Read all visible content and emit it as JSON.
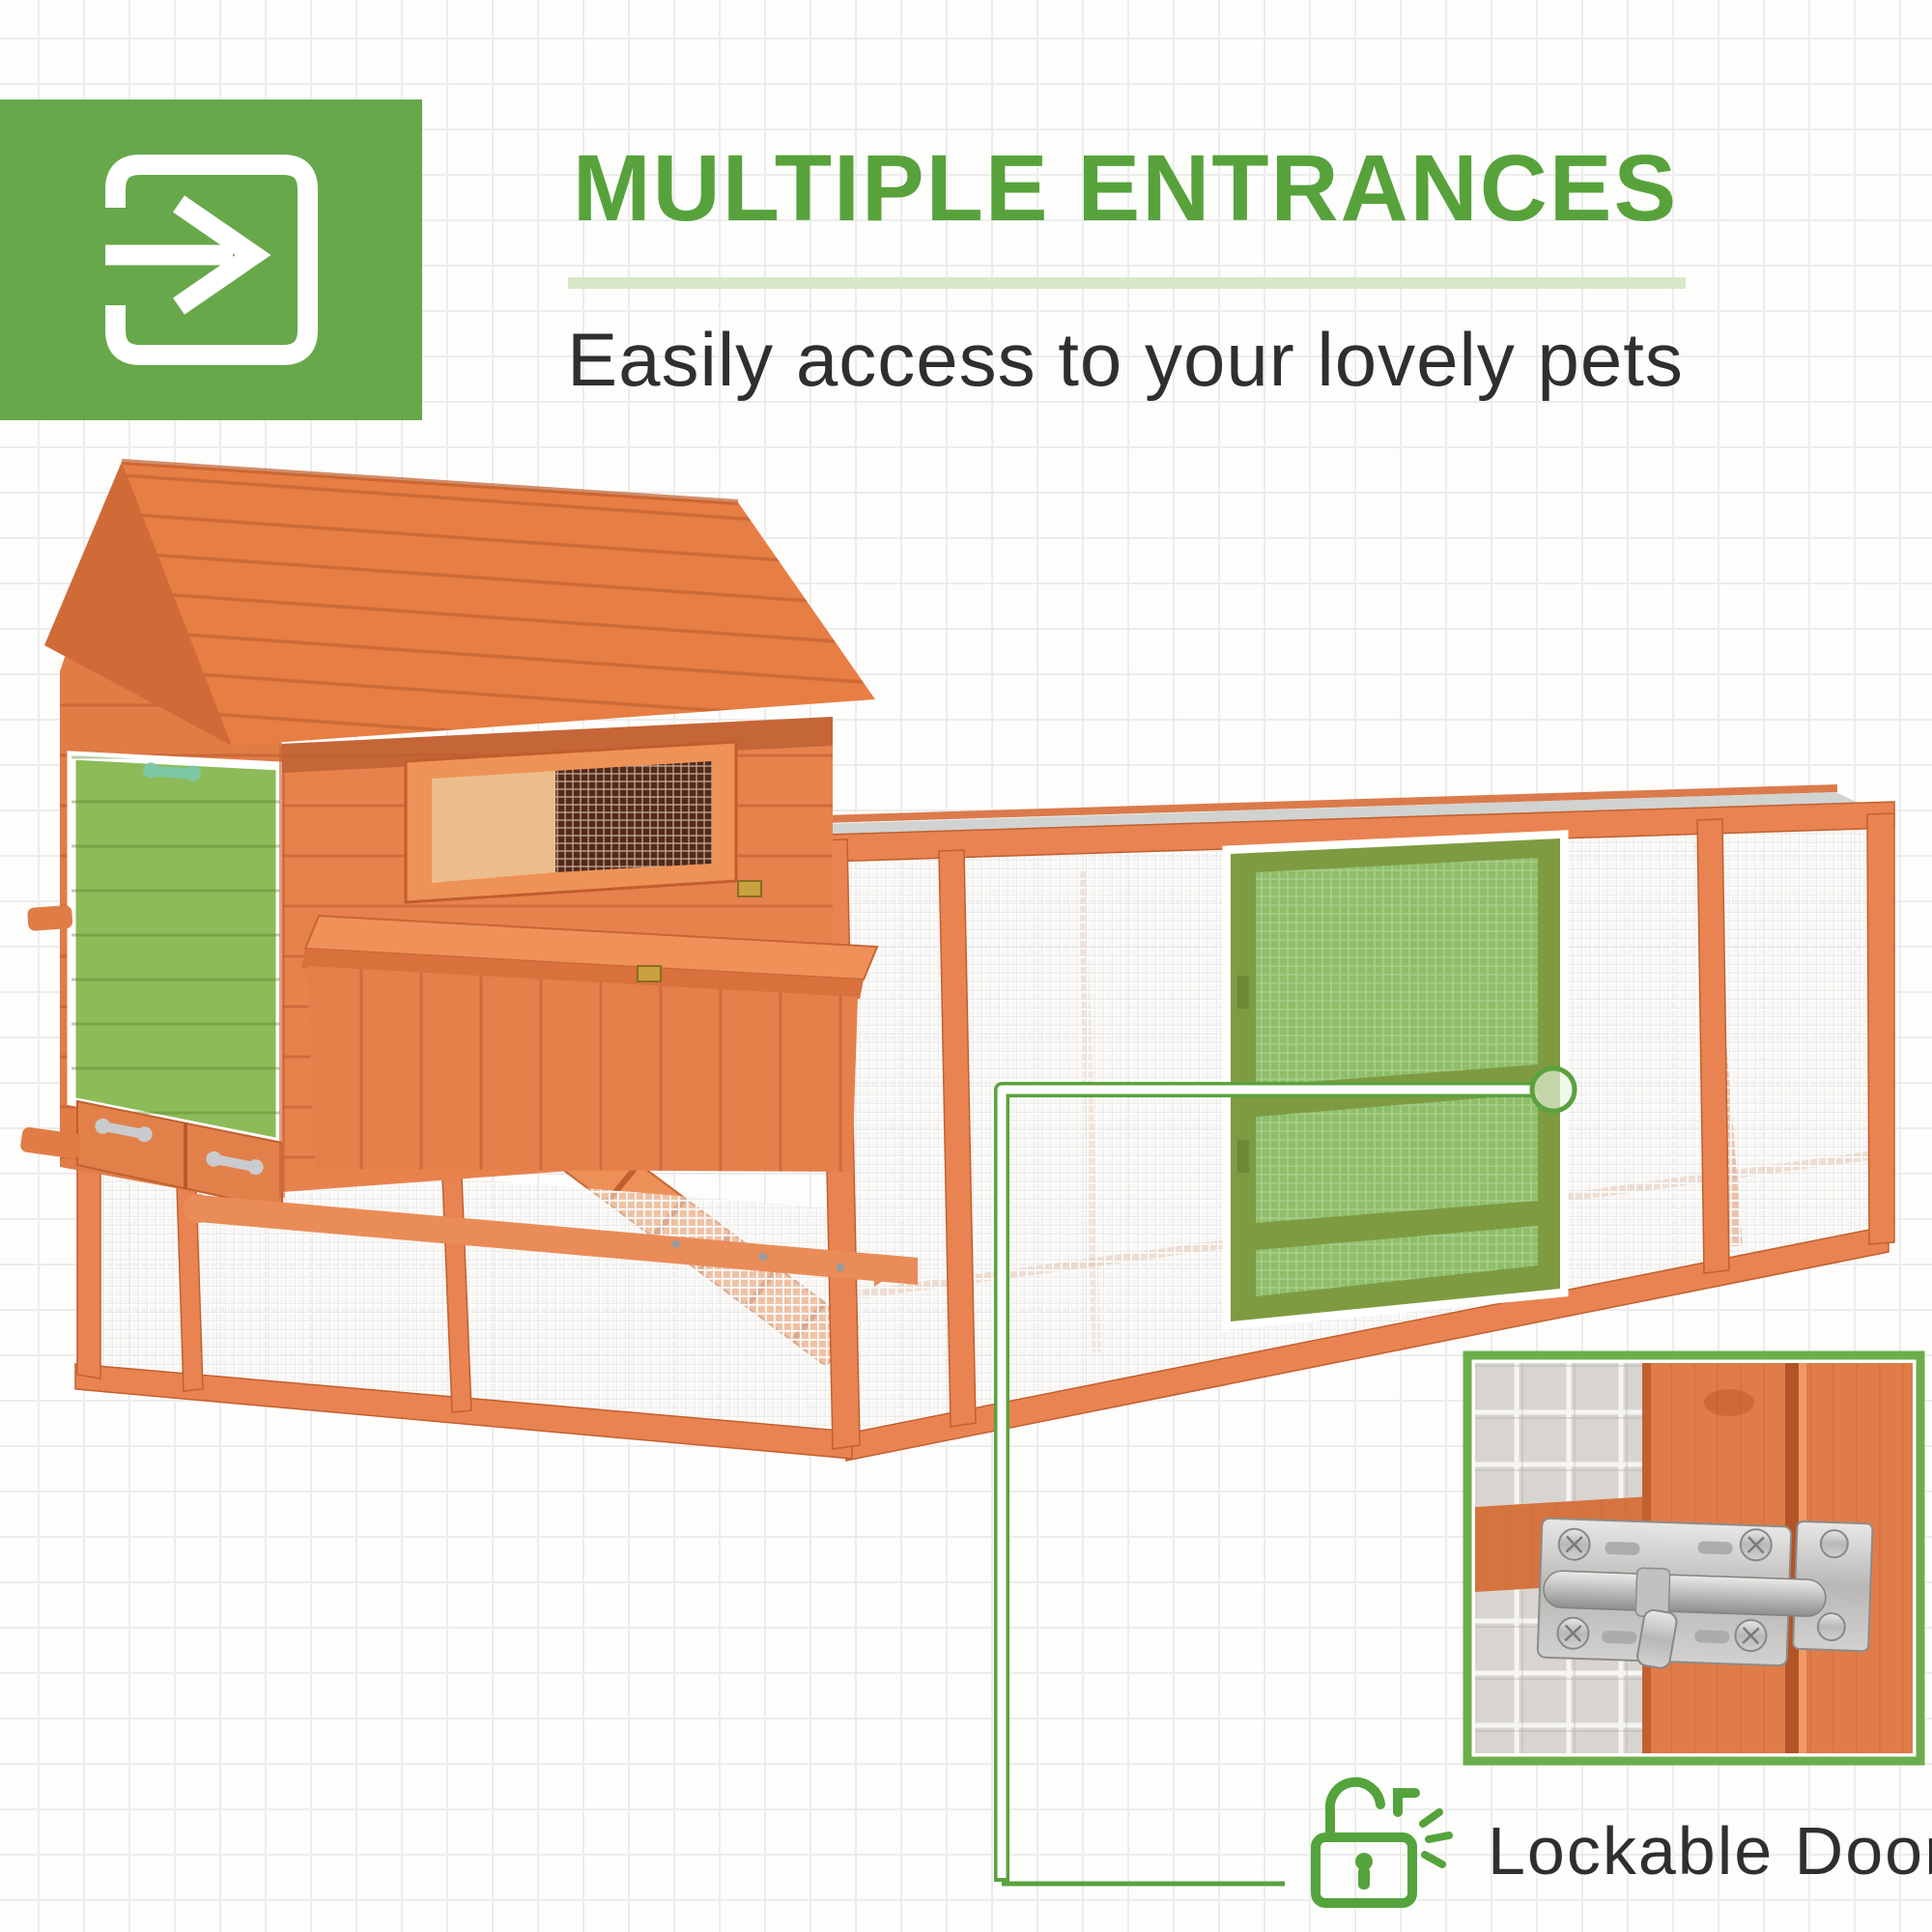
{
  "page": {
    "bg": "#fdfdfc",
    "grid_color": "#ececec"
  },
  "header": {
    "badge_icon": "enter-arrow-icon",
    "badge_color": "#67a84b",
    "title": "MULTIPLE ENTRANCES",
    "title_color": "#58a23c",
    "underline_color": "#dbe7c9",
    "subtitle": "Easily access to your lovely pets",
    "subtitle_color": "#2f2f2f"
  },
  "product": {
    "subject": "wooden chicken coop with pitched-roof house and long wire mesh run",
    "wood_color": "#e8834f",
    "roof_panel_color": "#cdd1cd",
    "mesh_color": "#f3f1ee",
    "highlight_door_mesh_color": "#8fbe6b",
    "highlight_door_frame_color": "#7e9b42",
    "house_door_color": "#8cbb58",
    "highlighted_parts": [
      "house side door",
      "run front door"
    ]
  },
  "callout": {
    "line_color": "#5ba23e",
    "target": "run door latch"
  },
  "inset": {
    "border_color": "#6cae4c",
    "subject": "close-up of sliding barrel bolt latch on wooden door"
  },
  "caption": {
    "icon": "open-padlock-icon",
    "icon_color": "#55a33c",
    "label": "Lockable Doors",
    "label_color": "#2f2f2f"
  }
}
